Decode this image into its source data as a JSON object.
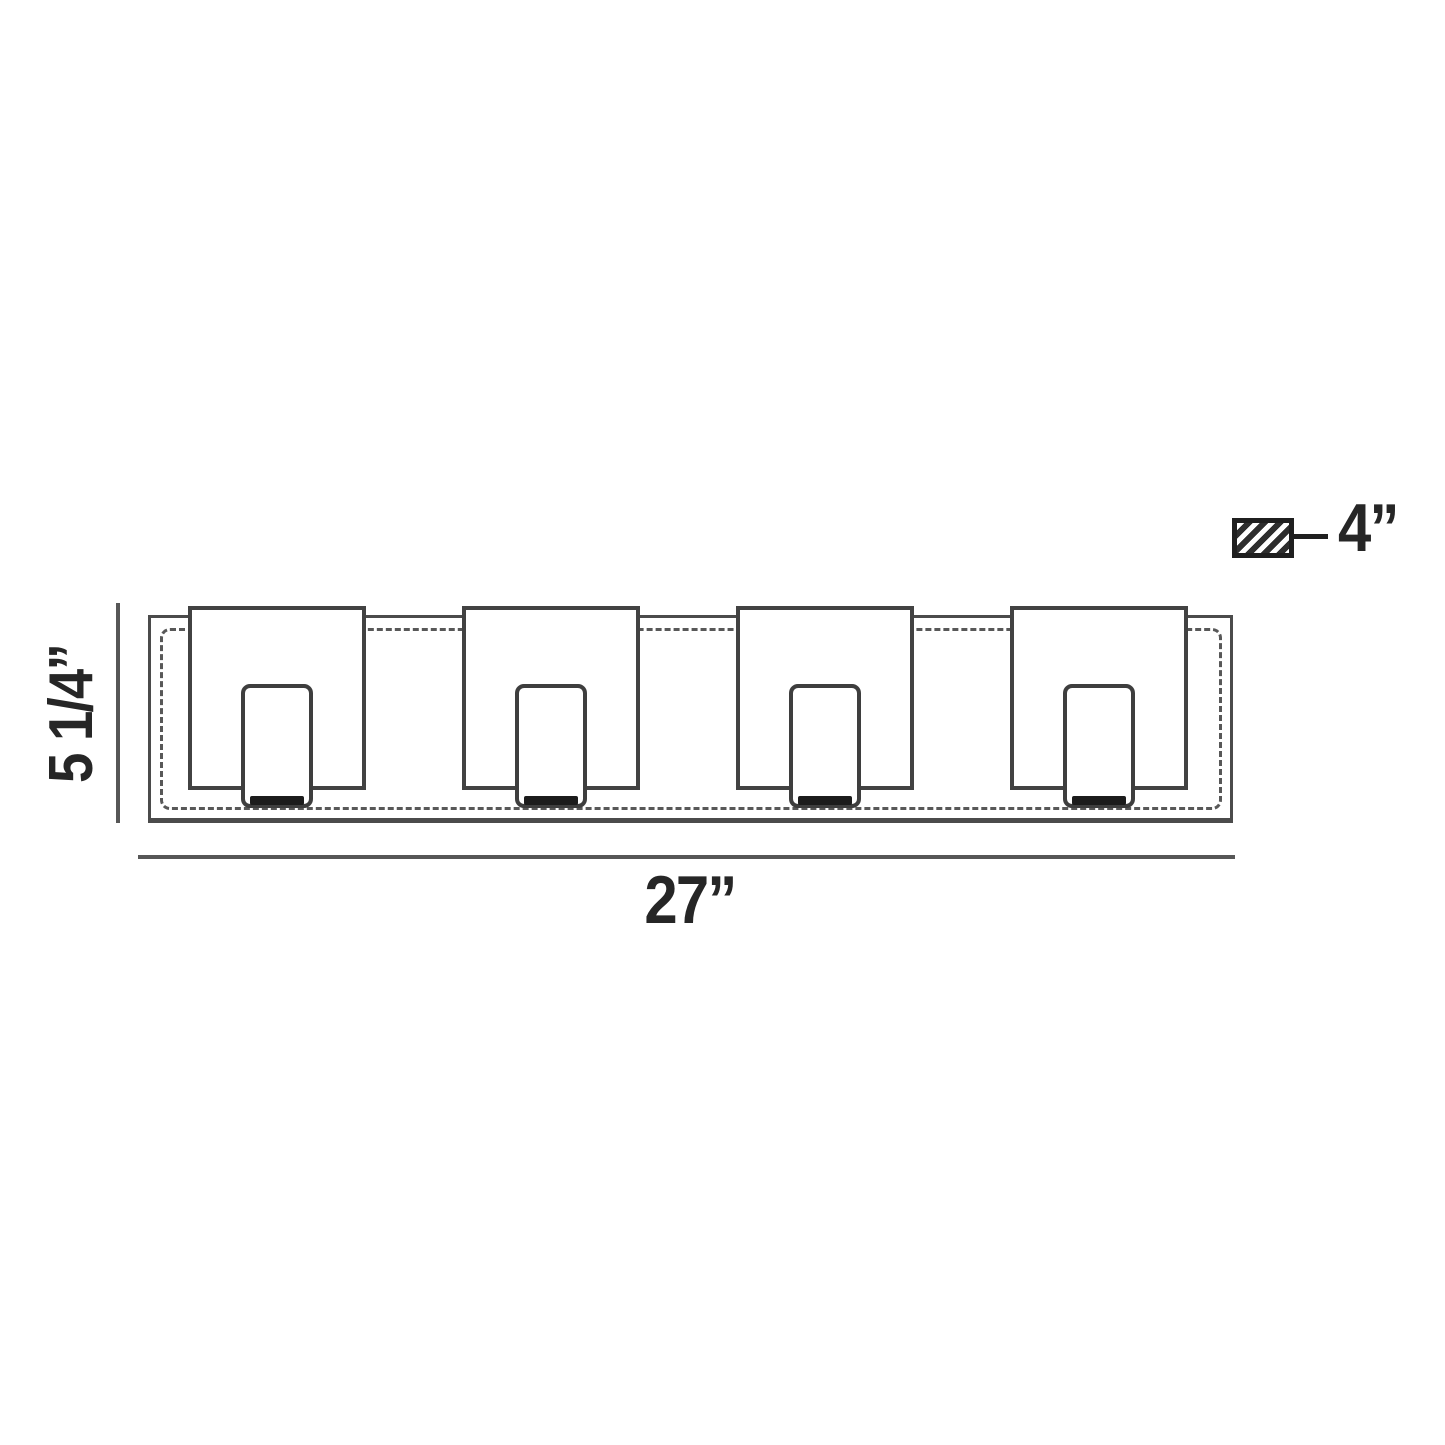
{
  "diagram": {
    "type": "product-dimension-drawing",
    "view": "front-elevation",
    "shade_count": 4,
    "dimensions": {
      "height_label": "5 1/4”",
      "width_label": "27”",
      "depth_label": "4”"
    },
    "icons": {
      "depth_swatch": "hatched-rectangle-depth-swatch"
    },
    "colors": {
      "line": "#4b4b4b",
      "dark_line": "#1f1f1f",
      "text": "#262626",
      "background": "#ffffff"
    }
  }
}
